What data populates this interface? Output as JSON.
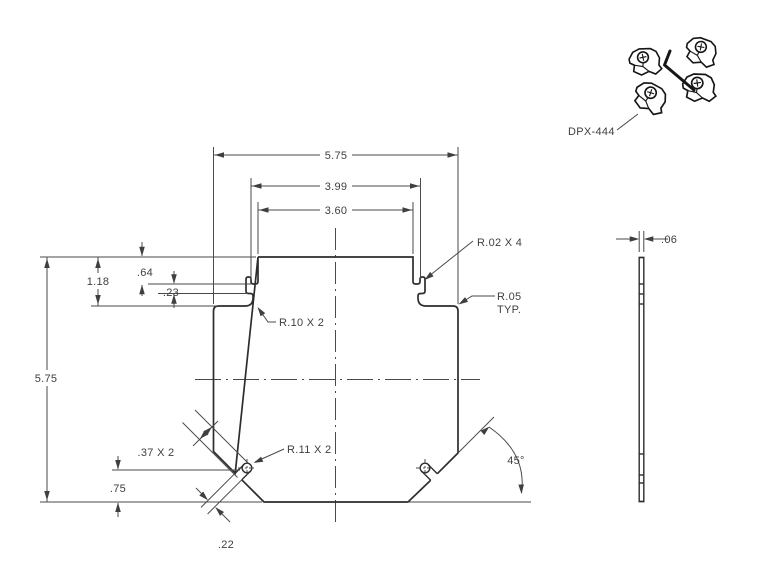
{
  "drawing": {
    "part_label": "DPX-444",
    "dimensions": {
      "overall_width": "5.75",
      "slot_span_width": "3.99",
      "tab_width": "3.60",
      "overall_height": "5.75",
      "shoulder_depth": "1.18",
      "slit_depth": ".64",
      "step_depth": ".23",
      "slot_center_height": ".75",
      "slot_width": ".22",
      "slot_length": ".37 X 2",
      "chamfer_angle": "45°",
      "thickness": ".06"
    },
    "notes": {
      "corner_radius": "R.02 X 4",
      "typ_radius_line1": "R.05",
      "typ_radius_line2": "TYP.",
      "fillet_radius": "R.10 X 2",
      "slot_end_radius": "R.11 X 2"
    }
  },
  "colors": {
    "background": "#ffffff",
    "part_edge": "#2d2d2d",
    "dimension_line": "#4a4a4a",
    "text": "#3f3f3f"
  }
}
